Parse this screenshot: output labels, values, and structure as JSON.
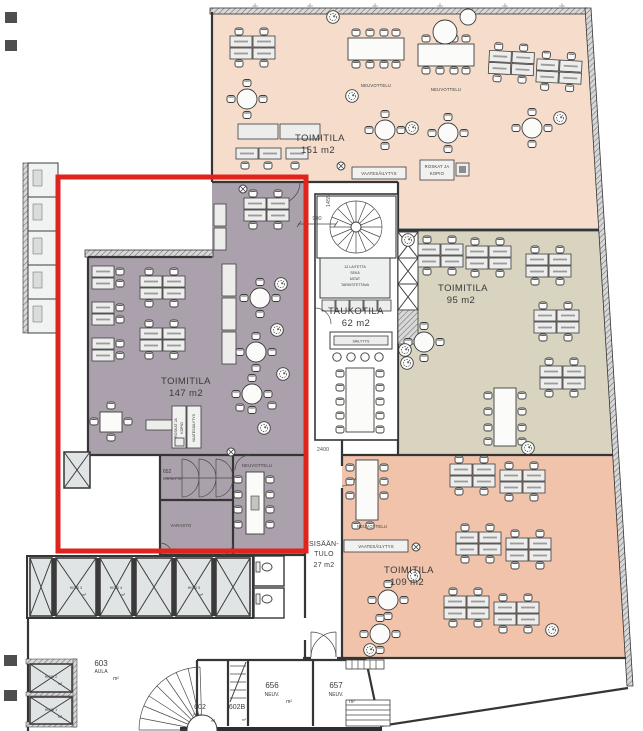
{
  "zones": {
    "toimitila_151": {
      "name": "TOIMITILA",
      "area": "151 m2",
      "color": "#f6ddcb"
    },
    "toimitila_95": {
      "name": "TOIMITILA",
      "area": "95 m2",
      "color": "#d8d4c0"
    },
    "toimitila_147": {
      "name": "TOIMITILA",
      "area": "147 m2",
      "color": "#aba1ac"
    },
    "toimitila_109": {
      "name": "TOIMITILA",
      "area": "109 m2",
      "color": "#f2c3ab"
    },
    "taukotila": {
      "name": "TAUKOTILA",
      "area": "62 m2"
    },
    "sisaantulo": {
      "line1": "SISÄÄN-",
      "line2": "TULO",
      "area": "27 m2"
    }
  },
  "rooms": {
    "r652": {
      "number": "652",
      "name": "RISTIKYTK."
    },
    "r603": {
      "number": "603",
      "name": "AULA",
      "unit": "m²"
    },
    "r602": {
      "number": "602",
      "name": "PRH",
      "unit": "m²"
    },
    "r602b": {
      "number": "602B",
      "unit": "m²"
    },
    "r656": {
      "number": "656",
      "name": "NEUV.",
      "unit": "m²"
    },
    "r657": {
      "number": "657",
      "name": "NEUV.",
      "unit": "m²"
    },
    "hissi1": {
      "name": "HISSI 1",
      "unit": "m²"
    },
    "hissi2": {
      "name": "HISSI 2",
      "unit": "m²"
    },
    "hissi3": {
      "name": "HISSI 3",
      "unit": "m²"
    },
    "hissi4": {
      "name": "HISSI 4",
      "unit": "m²"
    },
    "hissi5": {
      "name": "HISSI 5",
      "unit": "m²"
    }
  },
  "annotations": {
    "neuvottelu": "NEUVOTTELU",
    "varasto": "VARASTO",
    "vaatesailytys": "VAATESÄILYTYS",
    "roskat_ja": "ROSKAT JA",
    "kopio": "KOPIO",
    "sailytys": "SÄILYTYS",
    "note_l1": "12 LAITETTA",
    "note_l2": "SEKÄ",
    "note_l3": "MITAT",
    "note_l4": "TARKISTETTAVA"
  },
  "dimensions": {
    "v": "1455",
    "w": "900",
    "e": "2400"
  },
  "highlight": {
    "color": "#e0231c"
  }
}
